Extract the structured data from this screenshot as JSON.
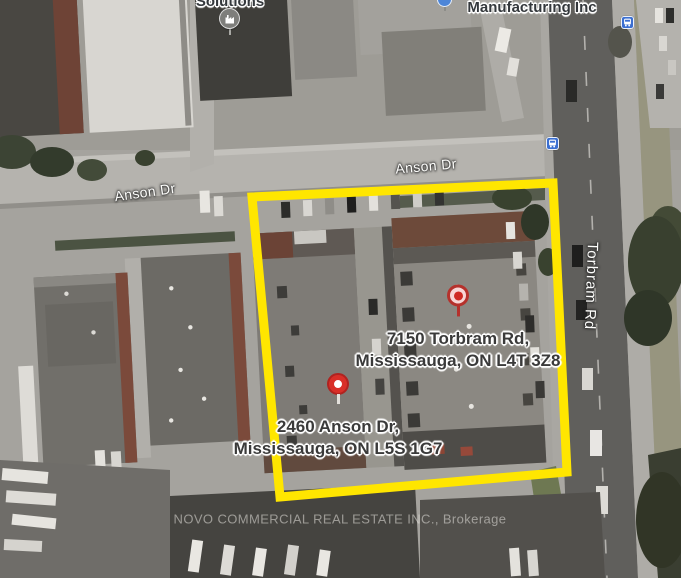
{
  "map": {
    "type": "satellite",
    "watermark": "NOVO COMMERCIAL REAL ESTATE INC., Brokerage",
    "road_labels": {
      "anson_west": "Anson Dr",
      "anson_east": "Anson Dr",
      "torbram": "Torbram Rd"
    },
    "poi_labels": {
      "solutions": "Solutions",
      "manufacturing": "Manufacturing Inc"
    },
    "markers": [
      {
        "id": "7150-torbram",
        "address_line1": "7150 Torbram Rd,",
        "address_line2": "Mississauga, ON L4T 3Z8",
        "pin_style": "light-circle-red-ring"
      },
      {
        "id": "2460-anson",
        "address_line1": "2460 Anson Dr,",
        "address_line2": "Mississauga, ON L5S 1G7",
        "pin_style": "solid-red-white-dot"
      }
    ],
    "icons": {
      "factory_poi": "factory-icon",
      "manufacturing_poi": "partial-blue-poi-icon",
      "transit_stops": [
        "bus-stop-icon",
        "bus-stop-icon"
      ]
    },
    "highlight": {
      "shape": "polygon",
      "color": "#ffe600",
      "meaning": "subject property boundary"
    },
    "colors": {
      "highlight_yellow": "#ffe600",
      "pin_red": "#c02a24",
      "transit_blue": "#3b6fd1",
      "watermark_gray": "#e3e1dc",
      "asphalt_gray": "#a5a39e",
      "road_dark": "#605f5c"
    }
  }
}
